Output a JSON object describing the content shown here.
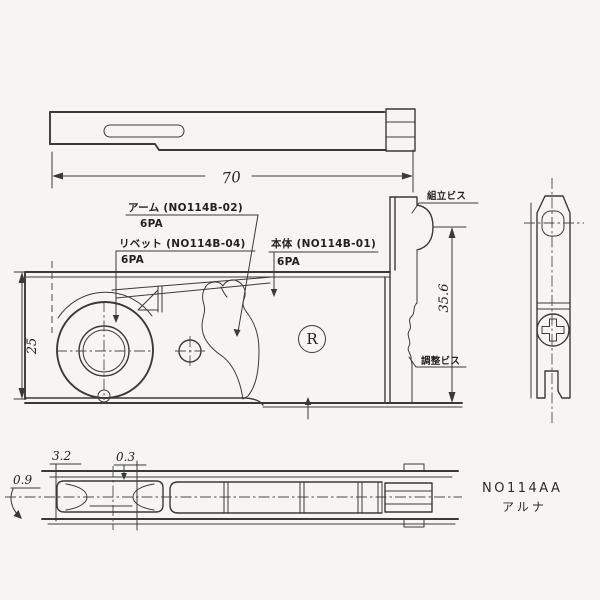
{
  "colors": {
    "background": "#f6f5f1",
    "line": "#3a3a3a"
  },
  "labels": {
    "arm": {
      "text": "アーム (NO114B-02)",
      "qty": "6PA"
    },
    "rivet": {
      "text": "リベット (NO114B-04)",
      "qty": "6PA"
    },
    "body": {
      "text": "本体 (NO114B-01)",
      "qty": "6PA"
    },
    "assembly_screw": "組立ビス",
    "adjustment_screw": "調整ビス",
    "registered_mark": "R"
  },
  "dimensions": {
    "overall_length": "70",
    "overall_height": "25",
    "bracket_height": "35.6",
    "plate_thickness": "3.2",
    "gap": "0.3",
    "edge_thickness": "0.9"
  },
  "title_block": {
    "model_no": "NO114AA",
    "brand": "アルナ"
  }
}
